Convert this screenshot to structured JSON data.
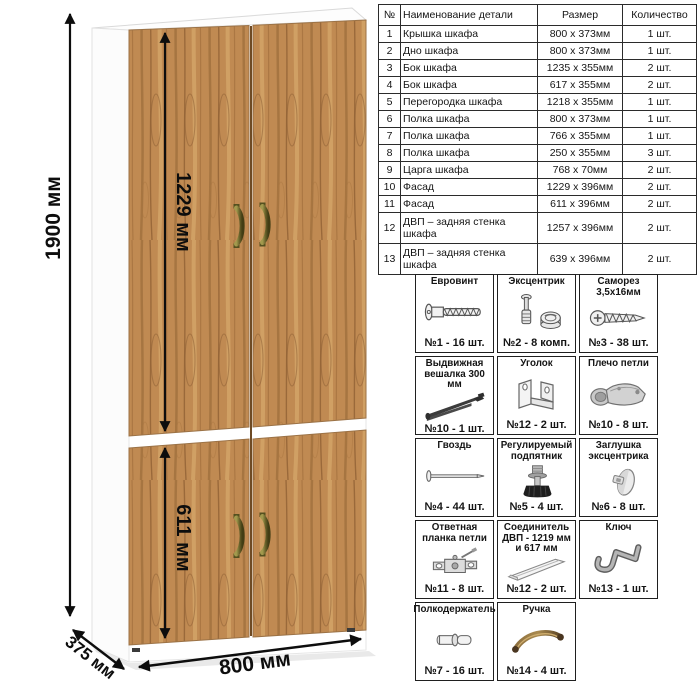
{
  "drawing": {
    "dims": {
      "total_height": "1900 мм",
      "upper_door_height": "1229 мм",
      "lower_door_height": "611 мм",
      "width": "800 мм",
      "depth": "375 мм"
    },
    "colors": {
      "wood": "#c08a52",
      "wood_dark": "#8a5c31",
      "carcass": "#ffffff",
      "handle_bronze": "#6b642c",
      "dimension_lines": "#0d0d0d"
    }
  },
  "parts_table": {
    "headers": {
      "num": "№",
      "name": "Наименование детали",
      "size": "Размер",
      "qty": "Количество"
    },
    "rows": [
      {
        "num": "1",
        "name": "Крышка шкафа",
        "size": "800 x 373мм",
        "qty": "1 шт."
      },
      {
        "num": "2",
        "name": "Дно шкафа",
        "size": "800 x 373мм",
        "qty": "1 шт."
      },
      {
        "num": "3",
        "name": "Бок шкафа",
        "size": "1235 x 355мм",
        "qty": "2 шт."
      },
      {
        "num": "4",
        "name": "Бок шкафа",
        "size": "617 x 355мм",
        "qty": "2 шт."
      },
      {
        "num": "5",
        "name": "Перегородка шкафа",
        "size": "1218 x 355мм",
        "qty": "1 шт."
      },
      {
        "num": "6",
        "name": "Полка шкафа",
        "size": "800 x 373мм",
        "qty": "1 шт."
      },
      {
        "num": "7",
        "name": "Полка шкафа",
        "size": "766 x 355мм",
        "qty": "1 шт."
      },
      {
        "num": "8",
        "name": "Полка шкафа",
        "size": "250 x 355мм",
        "qty": "3 шт."
      },
      {
        "num": "9",
        "name": "Царга шкафа",
        "size": "768 x 70мм",
        "qty": "2 шт."
      },
      {
        "num": "10",
        "name": "Фасад",
        "size": "1229 x 396мм",
        "qty": "2 шт."
      },
      {
        "num": "11",
        "name": "Фасад",
        "size": "611 x 396мм",
        "qty": "2 шт."
      },
      {
        "num": "12",
        "name": "ДВП – задняя стенка шкафа",
        "size": "1257 x 396мм",
        "qty": "2 шт."
      },
      {
        "num": "13",
        "name": "ДВП – задняя стенка шкафа",
        "size": "639 x 396мм",
        "qty": "2 шт."
      }
    ]
  },
  "hardware": {
    "items": [
      {
        "title": "Евровинт",
        "count": "№1 - 16 шт.",
        "icon": "euroscrew-icon"
      },
      {
        "title": "Эксцентрик",
        "count": "№2 - 8 комп.",
        "icon": "cam-lock-icon"
      },
      {
        "title": "Саморез 3,5х16мм",
        "count": "№3 - 38 шт.",
        "icon": "screw-icon"
      },
      {
        "title": "Выдвижная вешалка 300 мм",
        "count": "№10 - 1 шт.",
        "icon": "pullout-hanger-icon"
      },
      {
        "title": "Уголок",
        "count": "№12 - 2 шт.",
        "icon": "corner-bracket-icon"
      },
      {
        "title": "Плечо петли",
        "count": "№10 - 8 шт.",
        "icon": "hinge-arm-icon"
      },
      {
        "title": "Гвоздь",
        "count": "№4 - 44 шт.",
        "icon": "nail-icon"
      },
      {
        "title": "Регулируемый подпятник",
        "count": "№5 - 4 шт.",
        "icon": "adjustable-foot-icon"
      },
      {
        "title": "Заглушка эксцентрика",
        "count": "№6 - 8 шт.",
        "icon": "cam-cap-icon"
      },
      {
        "title": "Ответная планка петли",
        "count": "№11 - 8 шт.",
        "icon": "hinge-plate-icon"
      },
      {
        "title": "Соединитель ДВП - 1219 мм и 617 мм",
        "count": "№12 - 2 шт.",
        "icon": "hdf-connector-icon"
      },
      {
        "title": "Ключ",
        "count": "№13 - 1 шт.",
        "icon": "hex-key-icon"
      },
      {
        "title": "Полкодержатель",
        "count": "№7 - 16 шт.",
        "icon": "shelf-pin-icon"
      },
      {
        "title": "Ручка",
        "count": "№14 - 4 шт.",
        "icon": "handle-icon"
      }
    ]
  }
}
